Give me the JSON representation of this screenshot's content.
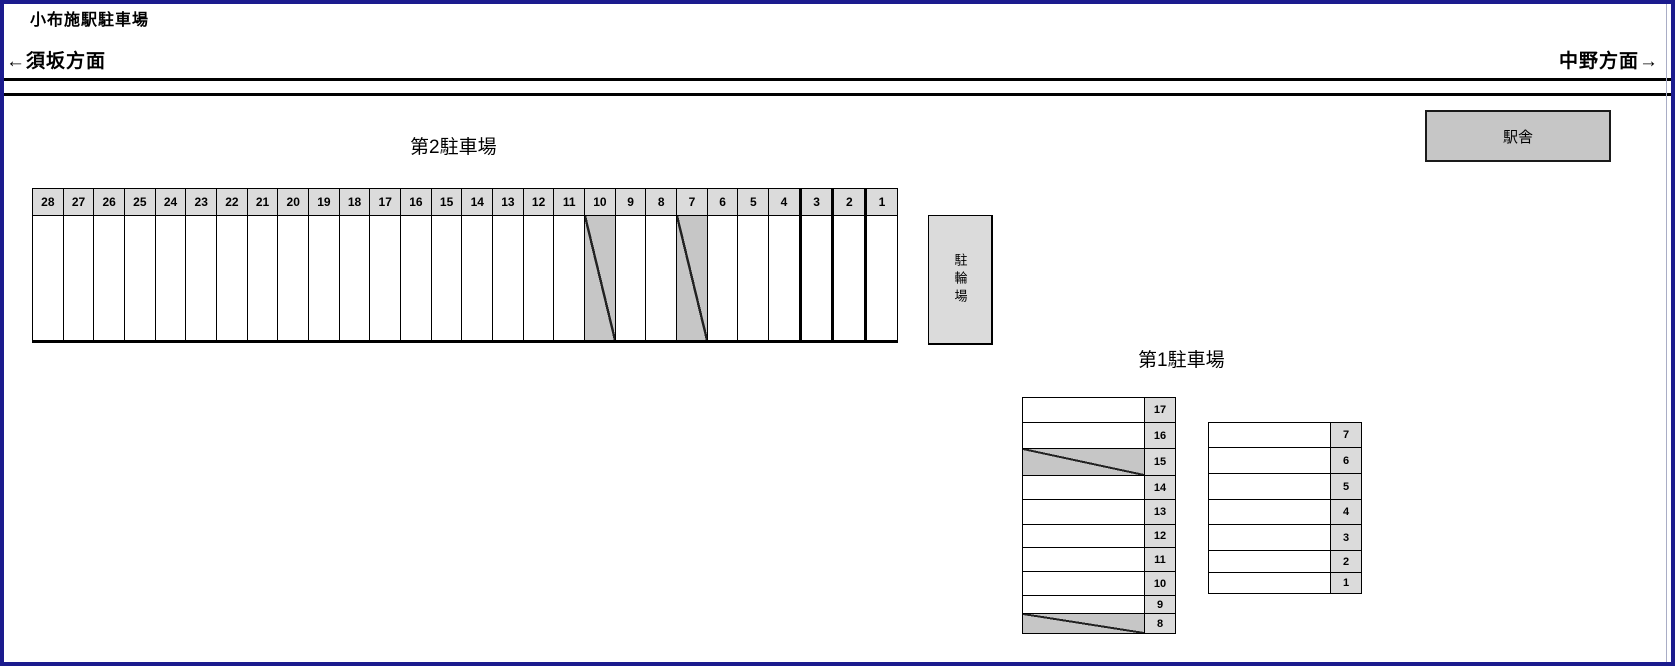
{
  "header": {
    "title": "小布施駅駐車場",
    "direction_left": "←須坂方面",
    "direction_right": "中野方面→"
  },
  "station_building": {
    "label": "駅舎"
  },
  "bicycle_parking": {
    "label": "駐輪場"
  },
  "lot2": {
    "title": "第2駐車場",
    "spaces": [
      {
        "num": "28",
        "occupied": false
      },
      {
        "num": "27",
        "occupied": false
      },
      {
        "num": "26",
        "occupied": false
      },
      {
        "num": "25",
        "occupied": false
      },
      {
        "num": "24",
        "occupied": false
      },
      {
        "num": "23",
        "occupied": false
      },
      {
        "num": "22",
        "occupied": false
      },
      {
        "num": "21",
        "occupied": false
      },
      {
        "num": "20",
        "occupied": false
      },
      {
        "num": "19",
        "occupied": false
      },
      {
        "num": "18",
        "occupied": false
      },
      {
        "num": "17",
        "occupied": false
      },
      {
        "num": "16",
        "occupied": false
      },
      {
        "num": "15",
        "occupied": false
      },
      {
        "num": "14",
        "occupied": false
      },
      {
        "num": "13",
        "occupied": false
      },
      {
        "num": "12",
        "occupied": false
      },
      {
        "num": "11",
        "occupied": false
      },
      {
        "num": "10",
        "occupied": true
      },
      {
        "num": "9",
        "occupied": false
      },
      {
        "num": "8",
        "occupied": false
      },
      {
        "num": "7",
        "occupied": true
      },
      {
        "num": "6",
        "occupied": false
      },
      {
        "num": "5",
        "occupied": false
      },
      {
        "num": "4",
        "occupied": false
      },
      {
        "num": "3",
        "occupied": false
      },
      {
        "num": "2",
        "occupied": false
      },
      {
        "num": "1",
        "occupied": false
      }
    ]
  },
  "lot1": {
    "title": "第1駐車場",
    "left_column": [
      {
        "num": "17",
        "occupied": false
      },
      {
        "num": "16",
        "occupied": false
      },
      {
        "num": "15",
        "occupied": true
      },
      {
        "num": "14",
        "occupied": false
      },
      {
        "num": "13",
        "occupied": false
      },
      {
        "num": "12",
        "occupied": false
      },
      {
        "num": "11",
        "occupied": false
      },
      {
        "num": "10",
        "occupied": false
      },
      {
        "num": "9",
        "occupied": false
      },
      {
        "num": "8",
        "occupied": true
      }
    ],
    "right_column": [
      {
        "num": "7",
        "occupied": false
      },
      {
        "num": "6",
        "occupied": false
      },
      {
        "num": "5",
        "occupied": false
      },
      {
        "num": "4",
        "occupied": false
      },
      {
        "num": "3",
        "occupied": false
      },
      {
        "num": "2",
        "occupied": false
      },
      {
        "num": "1",
        "occupied": false
      }
    ]
  },
  "colors": {
    "frame_blue": "#1b1b8e",
    "cell_gray": "#dbdbdb",
    "occupied_gray": "#c6c6c6"
  }
}
